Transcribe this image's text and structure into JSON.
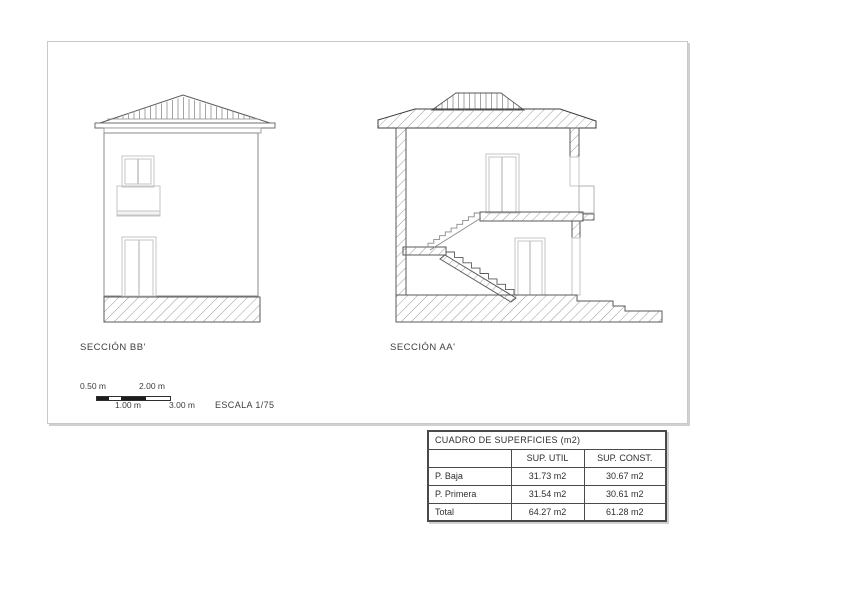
{
  "drawing": {
    "section_bb": {
      "label": "SECCIÓN BB'"
    },
    "section_aa": {
      "label": "SECCIÓN AA'"
    }
  },
  "scale": {
    "label_top_1": "0.50 m",
    "label_top_2": "2.00 m",
    "label_bottom_1": "1.00 m",
    "label_bottom_2": "3.00 m",
    "escala": "ESCALA 1/75"
  },
  "table": {
    "title": "CUADRO DE SUPERFICIES (m2)",
    "col_util": "SUP. UTIL",
    "col_const": "SUP. CONST.",
    "rows": [
      {
        "label": "P. Baja",
        "util": "31.73 m2",
        "const": "30.67 m2"
      },
      {
        "label": "P. Primera",
        "util": "31.54 m2",
        "const": "30.61 m2"
      },
      {
        "label": "Total",
        "util": "64.27 m2",
        "const": "61.28 m2"
      }
    ]
  },
  "colors": {
    "line_dark": "#4a4a4a",
    "line_mid": "#8a8a8a",
    "line_light": "#c4c4c4",
    "hatch": "#9a9a9a",
    "sheet_border": "#c9c9c9"
  }
}
